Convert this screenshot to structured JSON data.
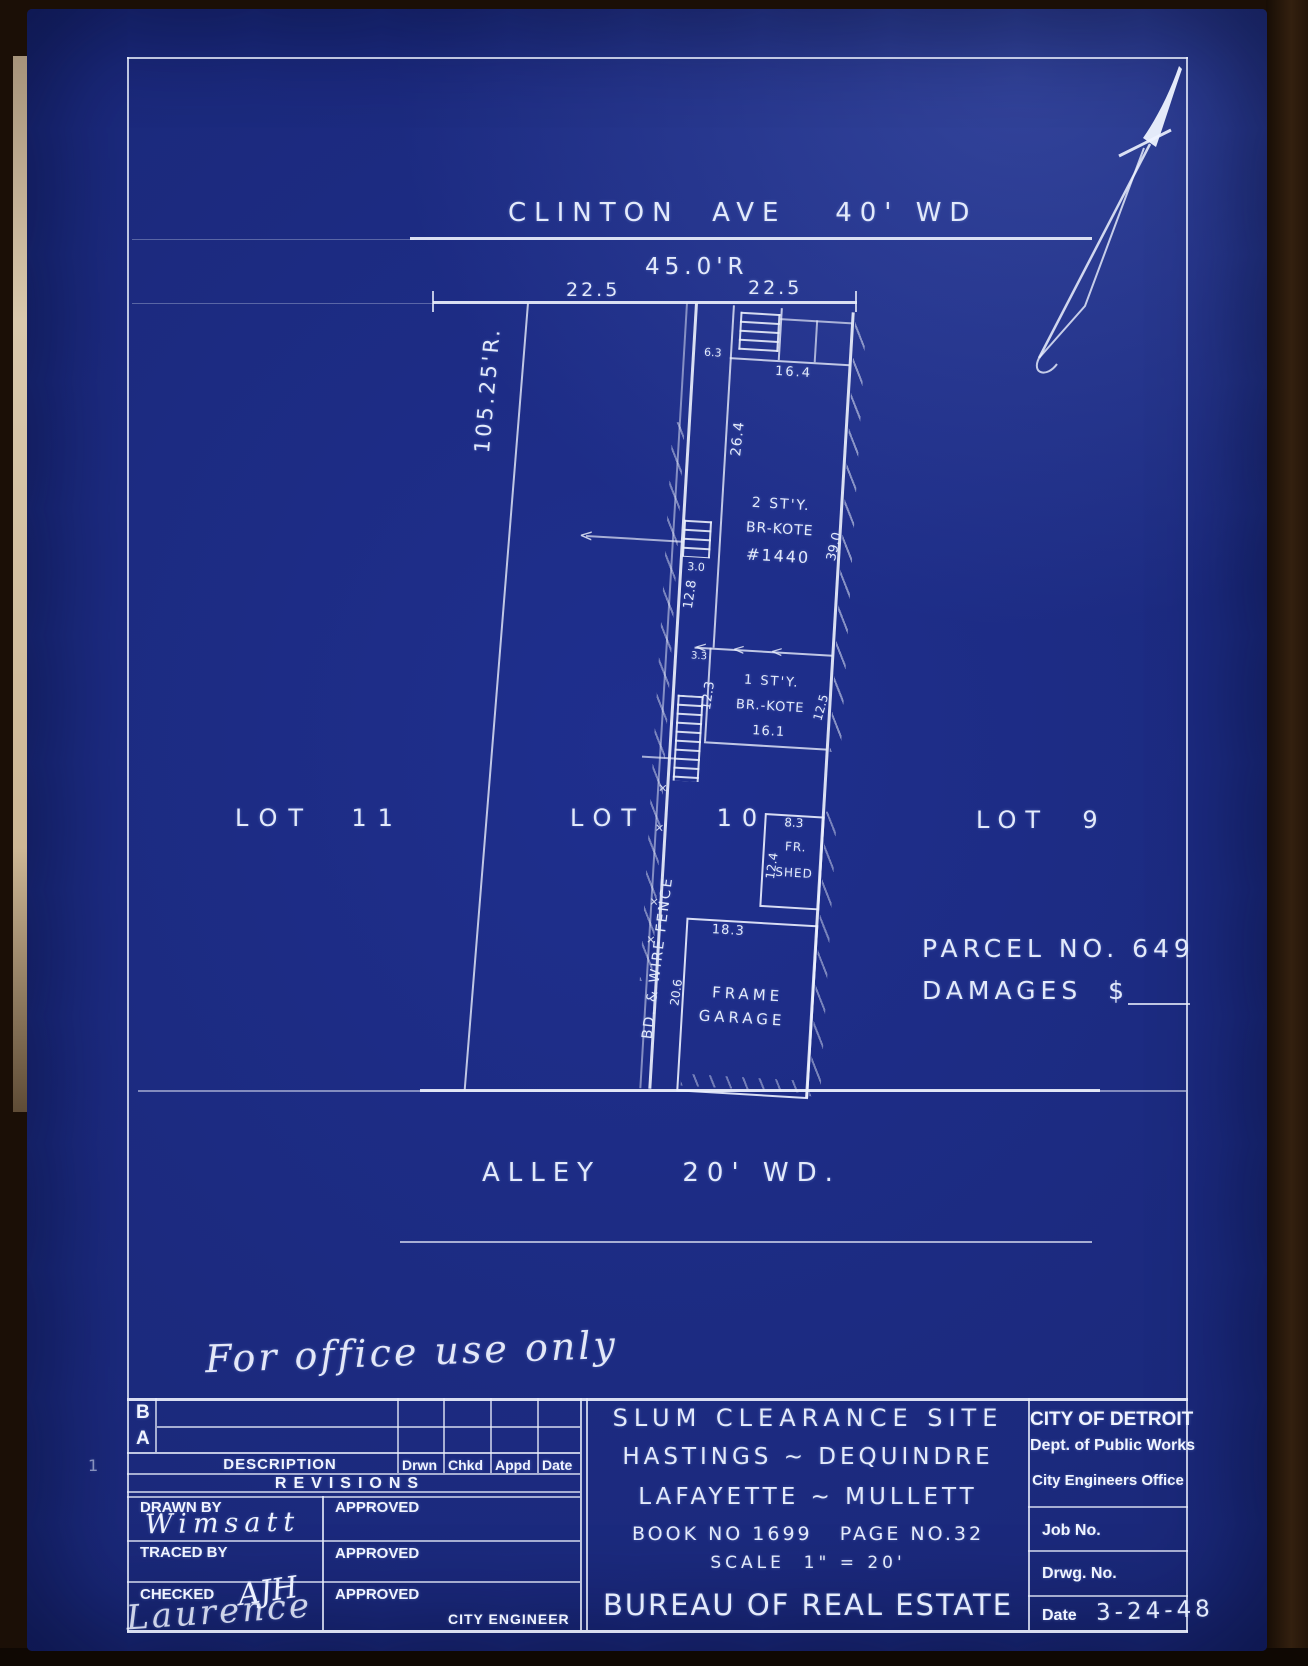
{
  "plan": {
    "street": "CLINTON  AVE   40' WD",
    "frontage_record": "45.0'R",
    "frontage_left": "22.5",
    "frontage_right": "22.5",
    "west_line_record": "105.25'R.",
    "lot_left": "LOT  11",
    "lot_center": "LOT    10",
    "lot_right": "LOT  9",
    "alley": "ALLEY     20' WD.",
    "parcel_no": "PARCEL NO. 649",
    "damages": "DAMAGES  $",
    "fence": "BD. & WIRE FENCE",
    "house": {
      "story": "2 ST'Y.",
      "material": "BR-KOTE",
      "number": "#1440",
      "side_yard": "6.3",
      "front_width": "16.4",
      "west_len": "26.4",
      "east_len": "39.0",
      "steps_w": "3.0",
      "mid_west": "12.8"
    },
    "rear_house": {
      "offset": "3.3",
      "story": "1 ST'Y.",
      "material": "BR.-KOTE",
      "width": "16.1",
      "west_len": "12.3",
      "east_len": "12.5"
    },
    "shed": {
      "width": "8.3",
      "depth": "12.4",
      "line1": "FR.",
      "line2": "SHED"
    },
    "garage": {
      "width": "18.3",
      "depth": "20.6",
      "line1": "FRAME",
      "line2": "GARAGE"
    },
    "symbols": {
      "arrowhead": "<",
      "x_mark": "✕"
    }
  },
  "note": "For office use only",
  "margin_mark": "1",
  "title_block": {
    "revisions": {
      "row_b": "B",
      "row_a": "A",
      "description": "DESCRIPTION",
      "drwn": "Drwn",
      "chkd": "Chkd",
      "appd": "Appd",
      "date": "Date",
      "title": "REVISIONS"
    },
    "signatures": {
      "drawn_by": "DRAWN BY",
      "drawn_value": "Wimsatt",
      "traced_by": "TRACED BY",
      "checked": "CHECKED",
      "checked_initials": "AJH",
      "checked_signature": "Laurence",
      "approved1": "APPROVED",
      "approved2": "APPROVED",
      "approved3": "APPROVED",
      "city_engineer": "CITY ENGINEER"
    },
    "project": {
      "line1": "SLUM CLEARANCE SITE",
      "line2": "HASTINGS ~ DEQUINDRE",
      "line3": "LAFAYETTE ~ MULLETT",
      "book": "BOOK NO 1699   PAGE NO.32",
      "scale": "SCALE  1\" = 20'",
      "bureau": "BUREAU OF REAL ESTATE"
    },
    "agency": {
      "line1": "CITY OF DETROIT",
      "line2": "Dept. of Public Works",
      "line3": "City Engineers Office",
      "job": "Job No.",
      "drwg": "Drwg. No.",
      "date_label": "Date",
      "date_value": "3-24-48"
    }
  }
}
